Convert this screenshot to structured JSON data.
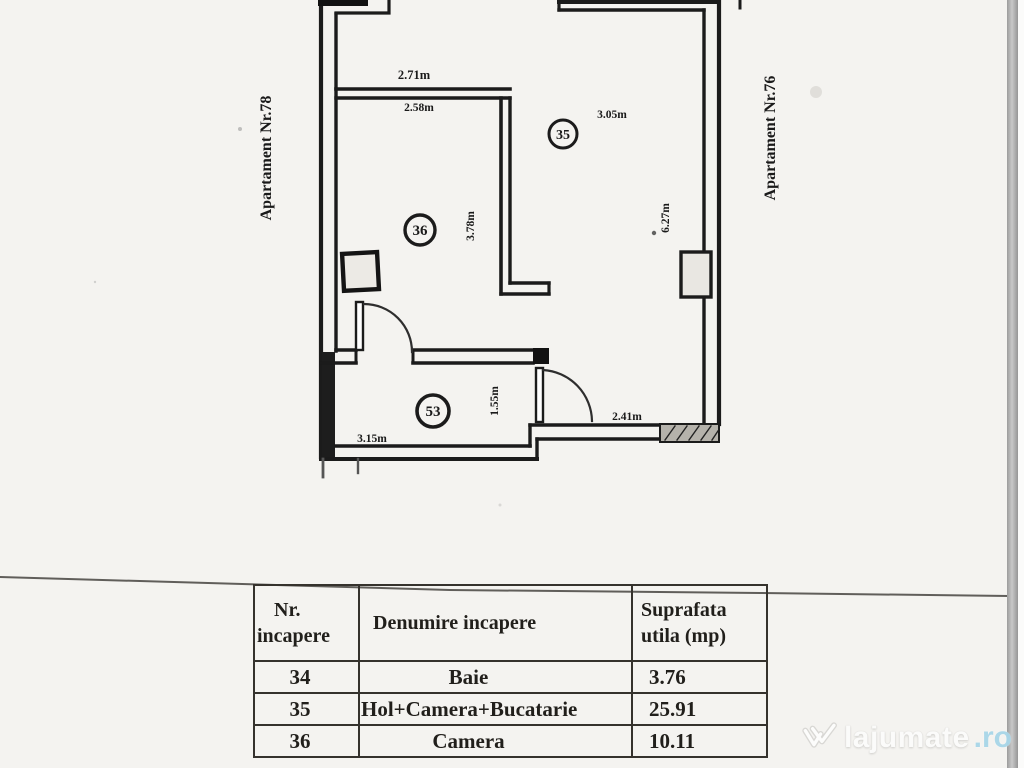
{
  "scan": {
    "background": "#f4f3f0",
    "ink_color": "#1b1b1b",
    "edge_bar_color": "#a8a8a8"
  },
  "floor_plan": {
    "apartment_left": "Apartament Nr.78",
    "apartment_right": "Apartament Nr.76",
    "room_numbers": {
      "living": "35",
      "camera": "36",
      "hall": "53"
    },
    "dimensions": {
      "top_outer": "2.71m",
      "top_inner": "2.58m",
      "living_width": "3.05m",
      "camera_height": "3.78m",
      "living_height": "6.27m",
      "hall_width": "3.15m",
      "bath_height": "1.55m",
      "bath_width": "2.41m"
    }
  },
  "table": {
    "headers": {
      "col1_line1": "Nr.",
      "col1_line2": "incapere",
      "col2": "Denumire incapere",
      "col3_line1": "Suprafata",
      "col3_line2": "utila (mp)"
    },
    "rows": [
      {
        "nr": "34",
        "name": "Baie",
        "area": "3.76"
      },
      {
        "nr": "35",
        "name": "Hol+Camera+Bucatarie",
        "area": "25.91"
      },
      {
        "nr": "36",
        "name": "Camera",
        "area": "10.11"
      }
    ]
  },
  "watermark": {
    "brand": "lajumate",
    "tld": ".ro",
    "tld_color": "#a9d6e8"
  }
}
